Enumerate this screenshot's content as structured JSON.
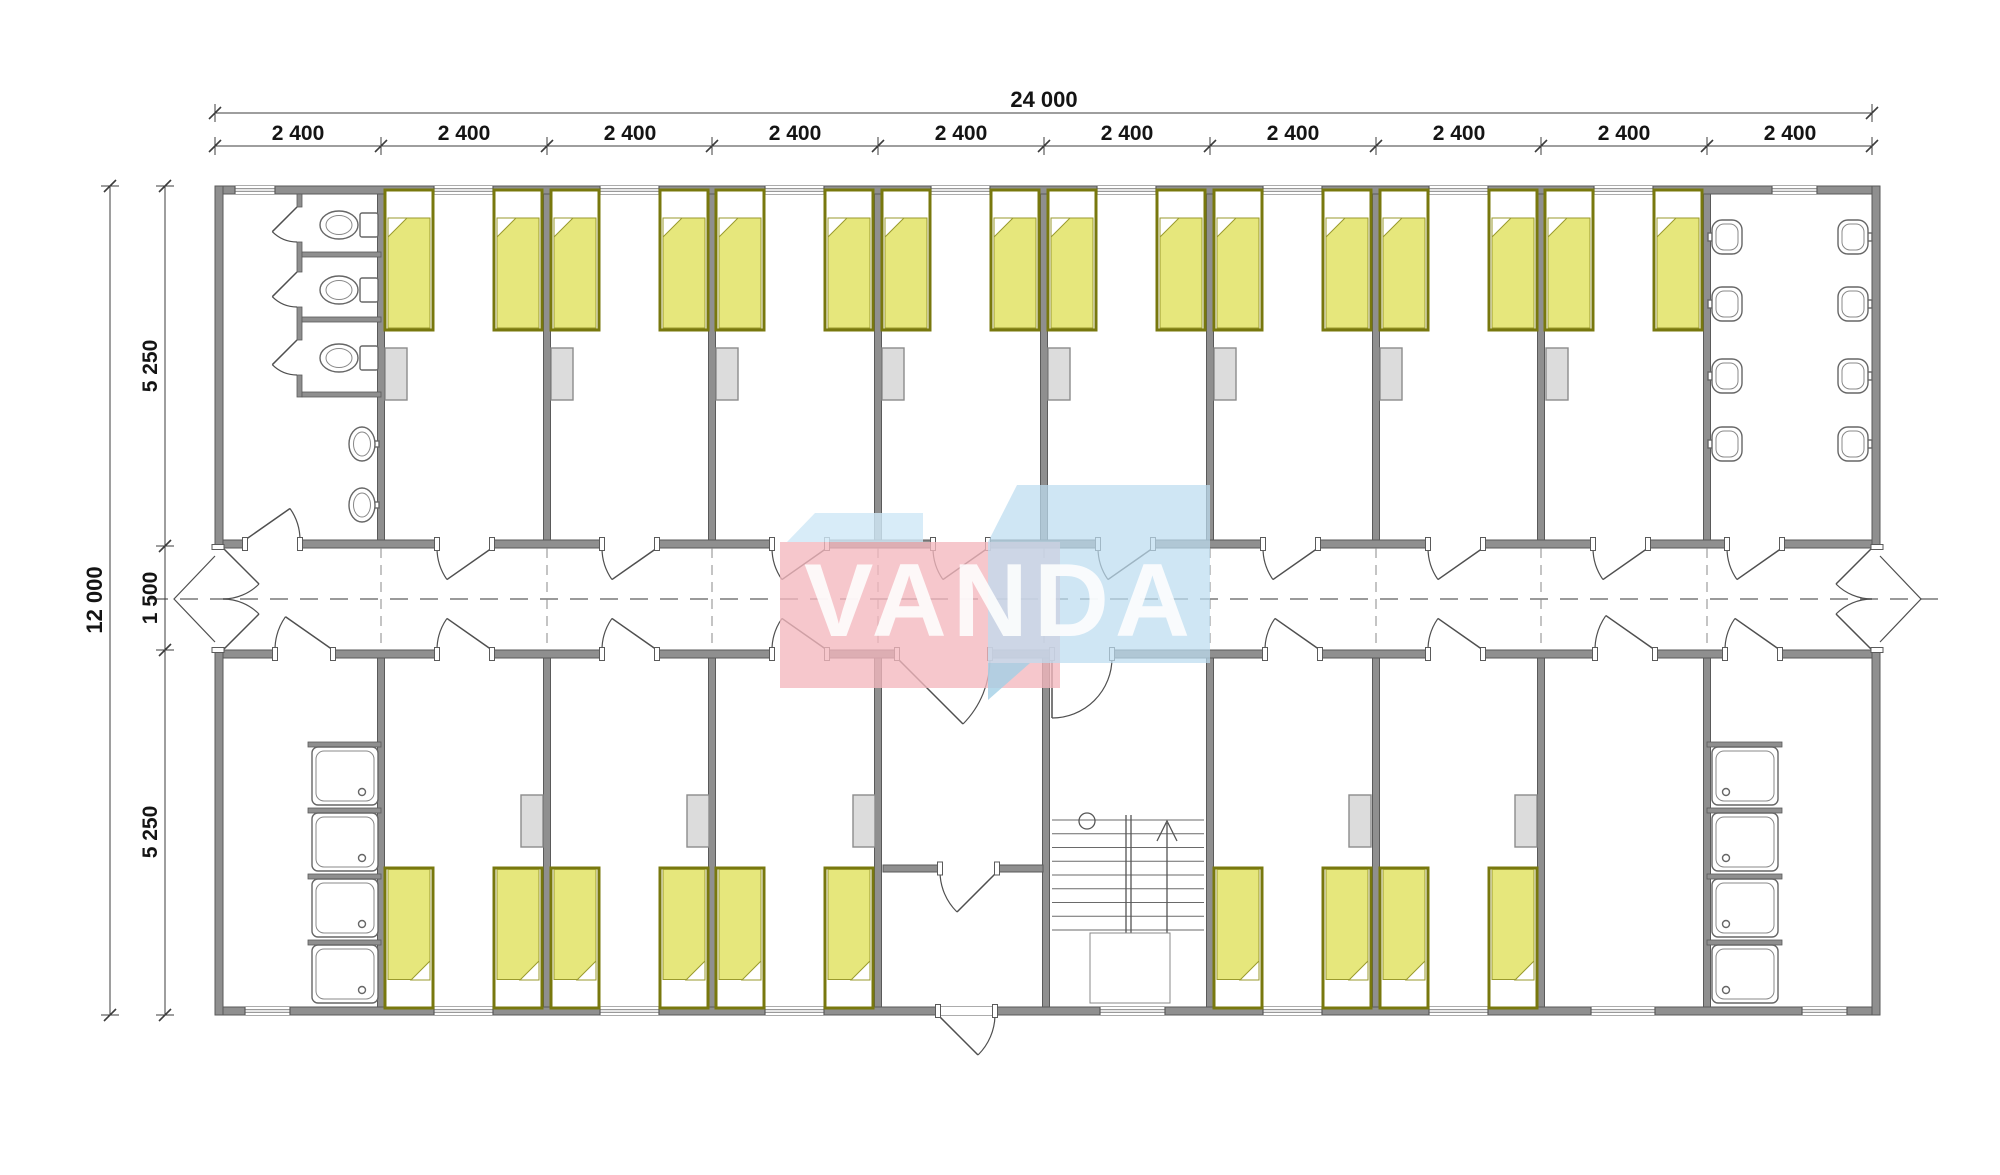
{
  "watermark": {
    "text": "VANDA"
  },
  "dimensions": {
    "top": {
      "total": "24 000",
      "segments": [
        "2 400",
        "2 400",
        "2 400",
        "2 400",
        "2 400",
        "2 400",
        "2 400",
        "2 400",
        "2 400",
        "2 400"
      ]
    },
    "left": {
      "total": "12 000",
      "segments": [
        "5 250",
        "1 500",
        "5 250"
      ]
    }
  },
  "colors": {
    "background": "#ffffff",
    "wall": "#8f8f8f",
    "wall_edge": "#5a5a5a",
    "bed_border": "#78780e",
    "bed_blanket": "#e6e77c",
    "bed_blanket_edge": "#9a9a2d",
    "furniture": "#dcdcdc",
    "furniture_edge": "#8c8c8c",
    "fixture": "#666666",
    "dimension": "#3c3c3c",
    "centerline": "#787878",
    "watermark_pink": "#f3b7be",
    "watermark_blue": "#bcdcf0",
    "watermark_bevel": "#cfe8f6",
    "watermark_accent": "#a2d0e6",
    "watermark_text": "#ffffff"
  }
}
